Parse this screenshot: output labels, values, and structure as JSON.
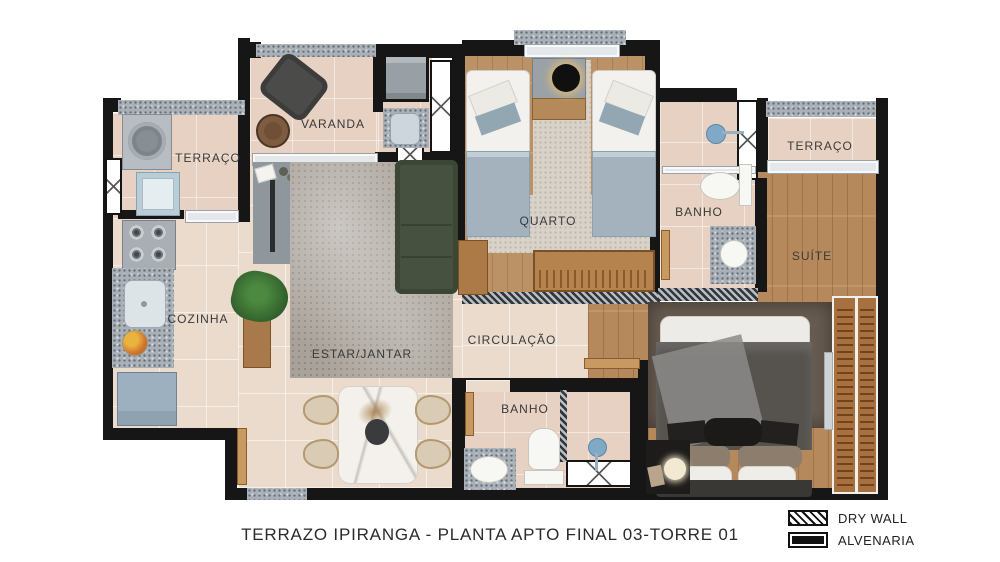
{
  "title": "TERRAZO IPIRANGA - PLANTA APTO FINAL 03-TORRE 01",
  "legend": {
    "drywall_label": "DRY WALL",
    "alvenaria_label": "ALVENARIA"
  },
  "rooms": {
    "terraco_servico": "TERRAÇO",
    "varanda": "VARANDA",
    "quarto": "QUARTO",
    "banho_suite": "BANHO",
    "terraco_suite": "TERRAÇO",
    "suite": "SUÍTE",
    "cozinha": "COZINHA",
    "estar_jantar": "ESTAR/JANTAR",
    "circulacao": "CIRCULAÇÃO",
    "banho_social": "BANHO"
  },
  "colors": {
    "wall_alvenaria": "#161616",
    "drywall_speckle": "#a9b0b7",
    "tile_floor": "#eadbcd",
    "wood_floor": "#b5895b",
    "sofa_green": "#46523f",
    "bed_blanket_blue": "#a3b2bd"
  }
}
